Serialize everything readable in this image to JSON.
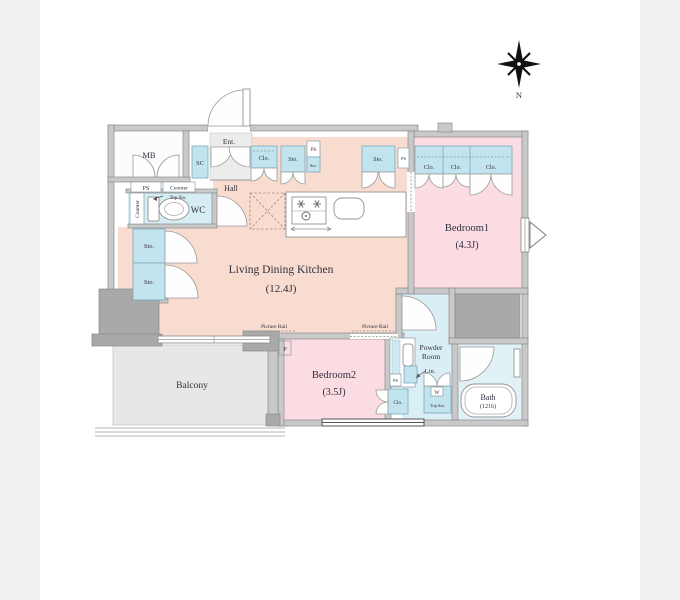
{
  "title": "1LDK apartment floor plan",
  "compass": {
    "north": "N"
  },
  "rooms": {
    "ldk": {
      "name": "Living Dining Kitchen",
      "size": "(12.4J)"
    },
    "bedroom1": {
      "name": "Bedroom1",
      "size": "(4.3J)"
    },
    "bedroom2": {
      "name": "Bedroom2",
      "size": "(3.5J)"
    },
    "balcony": {
      "name": "Balcony"
    },
    "powder_room": {
      "line1": "Powder",
      "line2": "Room"
    },
    "bath": {
      "name": "Bath",
      "size": "(1216)"
    },
    "wc": {
      "name": "WC"
    },
    "hall": {
      "name": "Hall"
    },
    "entrance": {
      "name": "Ent."
    },
    "meter_box": {
      "name": "MB"
    },
    "shoe_closet": {
      "name": "SC"
    }
  },
  "labels": {
    "pipe_space": "PS",
    "storage": "Sto.",
    "closet": "Clo.",
    "counter": "Counter",
    "top_storage": "Top Sto.",
    "linen": "Lin.",
    "picture_rail": "Picture Rail",
    "pole": "P",
    "washer": "W"
  },
  "colors": {
    "background": "#f0f0f0",
    "paper": "#fffffe",
    "ldk_fill": "#f8dcd0",
    "bedroom_fill": "#fbdce2",
    "wet_area_fill": "#d9eef4",
    "storage_fill": "#c2e4ef",
    "balcony_fill": "#e7e7e7",
    "wall_fill": "#c9c9c9",
    "pillar_fill": "#a9a9a9",
    "text": "#30303f"
  }
}
